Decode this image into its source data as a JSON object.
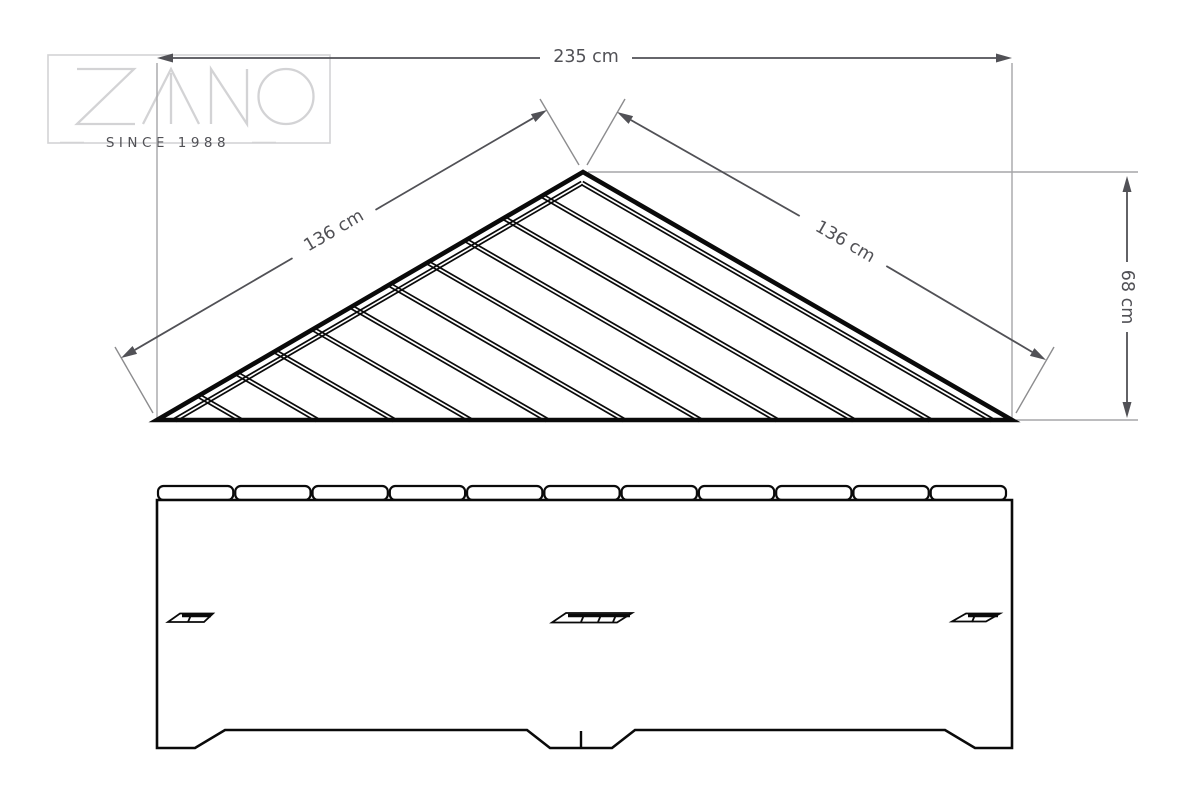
{
  "brand": {
    "name": "ZANO",
    "tagline": "SINCE 1988"
  },
  "dimensions": {
    "top_width": {
      "label": "235 cm"
    },
    "left_edge": {
      "label": "136 cm"
    },
    "right_edge": {
      "label": "136 cm"
    },
    "depth": {
      "label": "68 cm"
    }
  },
  "top_view": {
    "description": "triangular corner bench top view with diagonal slats",
    "slat_count": 10
  },
  "front_view": {
    "description": "front elevation with seat board ends, three slots and three feet",
    "board_count": 11,
    "slot_count": 3,
    "feet_count": 3
  },
  "colors": {
    "line": "#0a0a0a",
    "dimension": "#515156",
    "extension": "#a6a6a8",
    "extension_dark": "#8c8c8e",
    "logo": "#d3d3d5",
    "logo_text": "#c7c7c9",
    "background": "#ffffff"
  }
}
